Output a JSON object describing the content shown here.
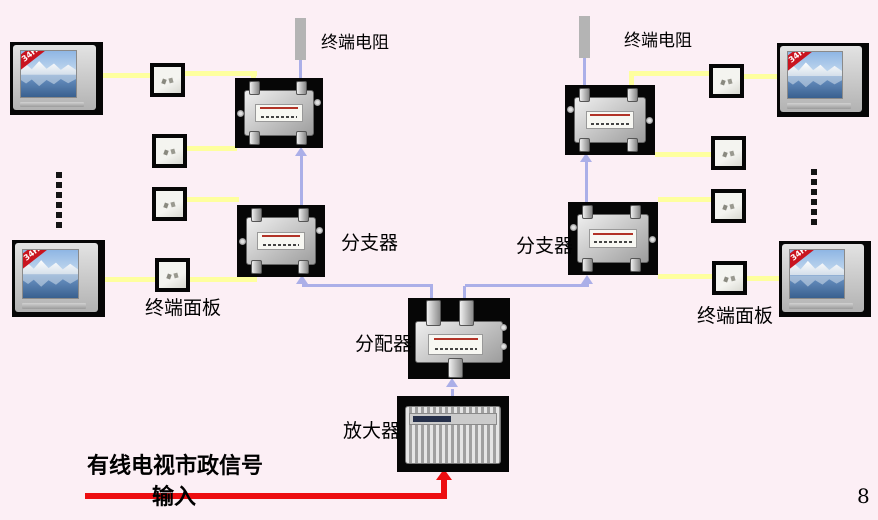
{
  "page": {
    "page_number": "8",
    "background_color": "#fceff5"
  },
  "labels": {
    "terminal_resistor_left": "终端电阻",
    "terminal_resistor_right": "终端电阻",
    "branch_left": "分支器",
    "branch_right": "分支器",
    "distributor": "分配器",
    "amplifier": "放大器",
    "terminal_panel_left": "终端面板",
    "terminal_panel_right": "终端面板",
    "signal_input_line1": "有线电视市政信号",
    "signal_input_line2": "输入",
    "tv_badge": "34H"
  },
  "colors": {
    "cable_yellow": "#feff9e",
    "trunk_blue": "#abafe8",
    "input_red": "#ed0e11",
    "resistor_gray": "#b4b4b4",
    "photo_background": "#060606"
  }
}
